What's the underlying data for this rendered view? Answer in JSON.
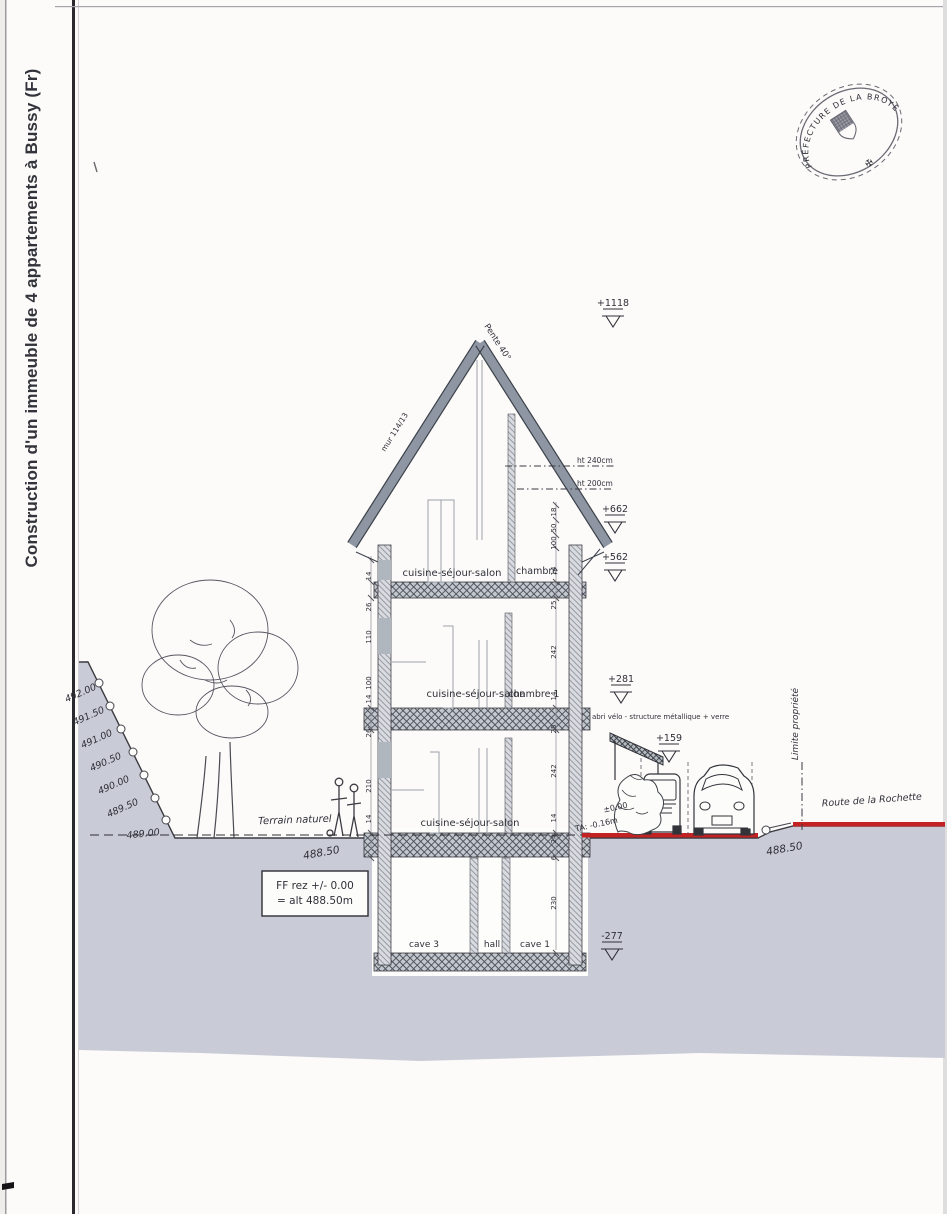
{
  "page_title": "Construction d'un immeuble de 4 appartements à Bussy (Fr)",
  "stamp": {
    "ring": "PRÉFECTURE DE LA BROYE",
    "ornament": "✠"
  },
  "roof": {
    "pente": "Pente 40°",
    "mur": "mur 114/13",
    "ht1": "ht 240cm",
    "ht2": "ht 200cm"
  },
  "markers": [
    "+1118",
    "+662",
    "+562",
    "+281",
    "+159",
    "-277"
  ],
  "rooms": {
    "attic_living": "cuisine-séjour-salon",
    "attic_bed": "chambre",
    "f1_living": "cuisine-séjour-salon",
    "f1_bed": "chambre 1",
    "gf_living": "cuisine-séjour-salon",
    "cave3": "cave 3",
    "hall": "hall",
    "cave1": "cave 1"
  },
  "terrain": {
    "contours": [
      "492.00",
      "491.50",
      "491.00",
      "490.50",
      "490.00",
      "489.50",
      "489.00"
    ],
    "natural": "Terrain naturel",
    "level_left": "488.50",
    "level_right": "488.50",
    "ta_plus": "±0.00",
    "ta": "TA: -0.16m",
    "limite": "Limite propriété",
    "route": "Route de la Rochette",
    "abri": "abri vélo - structure métallique + verre"
  },
  "ff_box": {
    "line1": "FF rez +/- 0.00",
    "line2": "= alt 488.50m"
  },
  "dims": {
    "left": [
      "14",
      "26",
      "110",
      "100",
      "14",
      "26",
      "210",
      "14"
    ],
    "right": [
      "18",
      "50",
      "100",
      "14",
      "25",
      "242",
      "14",
      "25",
      "242",
      "14",
      "24",
      "6",
      "230"
    ]
  },
  "colors": {
    "ground": "#c9cbd6",
    "roof": "#8d96a2",
    "road": "#c32222",
    "ink": "#2f2f38"
  }
}
